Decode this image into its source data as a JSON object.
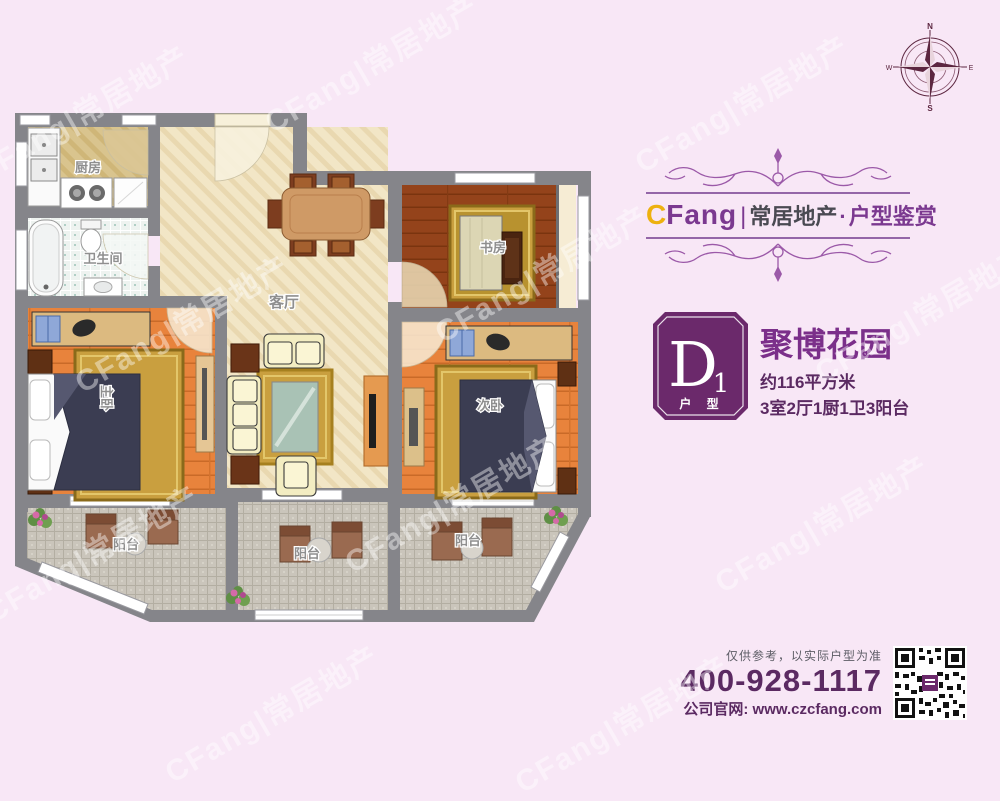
{
  "watermark": {
    "text": "CFang|常居地产"
  },
  "compass": {
    "n": "N",
    "e": "E",
    "s": "S",
    "w": "W"
  },
  "floor_plan": {
    "rooms": {
      "kitchen": "厨房",
      "bathroom": "卫生间",
      "living_room": "客厅",
      "study": "书房",
      "master_bedroom": "主卧",
      "second_bedroom": "次卧",
      "balcony_left": "阳台",
      "balcony_middle": "阳台",
      "balcony_right": "阳台"
    }
  },
  "brand": {
    "logo_c": "C",
    "logo_fang": "Fang",
    "divider": "|",
    "company": "常居地产",
    "dot": "·",
    "tagline": "户型鉴赏"
  },
  "listing": {
    "unit_letter": "D",
    "unit_number": "1",
    "unit_label": "户 型",
    "name": "聚博花园",
    "area": "约116平方米",
    "layout": "3室2厅1厨1卫3阳台"
  },
  "footer": {
    "disclaimer": "仅供参考，以实际户型为准",
    "phone": "400-928-1117",
    "website": "公司官网: www.czcfang.com"
  },
  "colors": {
    "background": "#f8e7f6",
    "wall": "#85858a",
    "accent_purple": "#7b2f8a",
    "dark_purple": "#5b2a62",
    "badge_purple": "#6b296b",
    "gold": "#edb10f"
  }
}
